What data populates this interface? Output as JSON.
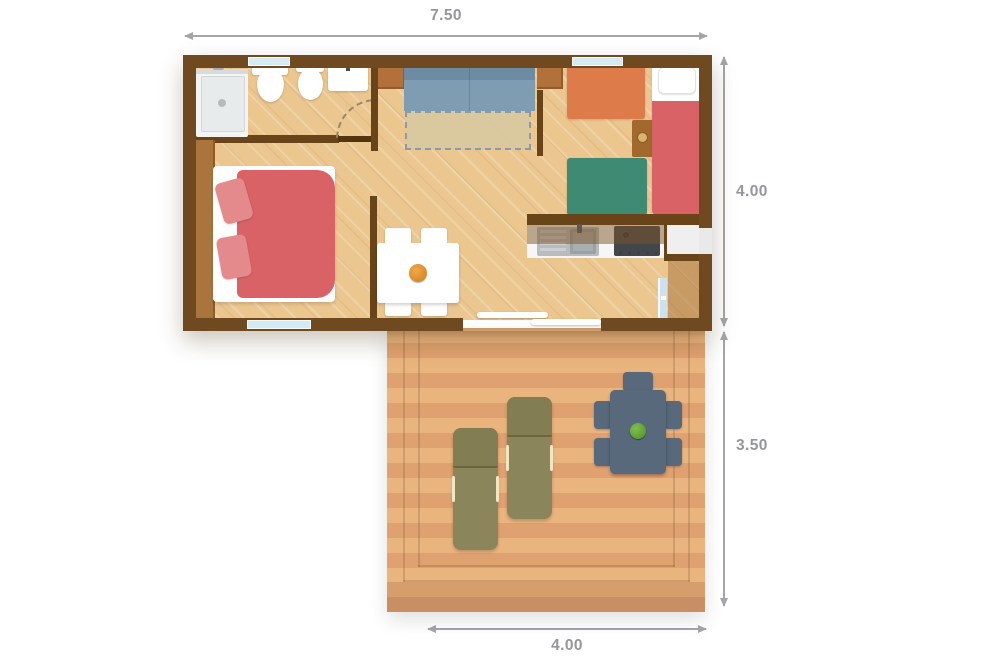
{
  "type": "floor-plan",
  "dimensions": {
    "top": "7.50",
    "right_upper": "4.00",
    "right_lower": "3.50",
    "bottom": "4.00"
  },
  "palette": {
    "wall_brown": "#6f4a21",
    "floor_tan": "#ebc68f",
    "deck_plank_light": "#eab47e",
    "deck_plank_dark": "#dfa170",
    "sofa_blue": "#7e9cb2",
    "sofa_bed_extension": "#d9c9a2",
    "bed_red": "#d96266",
    "pillow_pink": "#e4898c",
    "bed_orange": "#dd7b4b",
    "bed_green": "#3e8a72",
    "lounger_olive": "#8b855b",
    "outdoor_table_slate": "#57697b",
    "plant_green": "#5fa331",
    "window_glass": "#d6eaf1",
    "dimension_gray": "#949699"
  },
  "legend": {
    "depicted_elements": [
      "shower",
      "toilet",
      "bidet",
      "washbasin",
      "wardrobe",
      "double-bed",
      "sofa-bed",
      "tv",
      "dining-table",
      "dining-chairs",
      "fruit-bowl",
      "kitchen-sink",
      "cooktop",
      "fridge",
      "kitchen-cabinets",
      "single-bed-orange",
      "single-bed-green",
      "single-bed-red",
      "nightstand",
      "entrance-door",
      "sliding-door",
      "terrace-deck",
      "sun-loungers",
      "outdoor-table",
      "outdoor-chairs",
      "potted-plant"
    ]
  }
}
